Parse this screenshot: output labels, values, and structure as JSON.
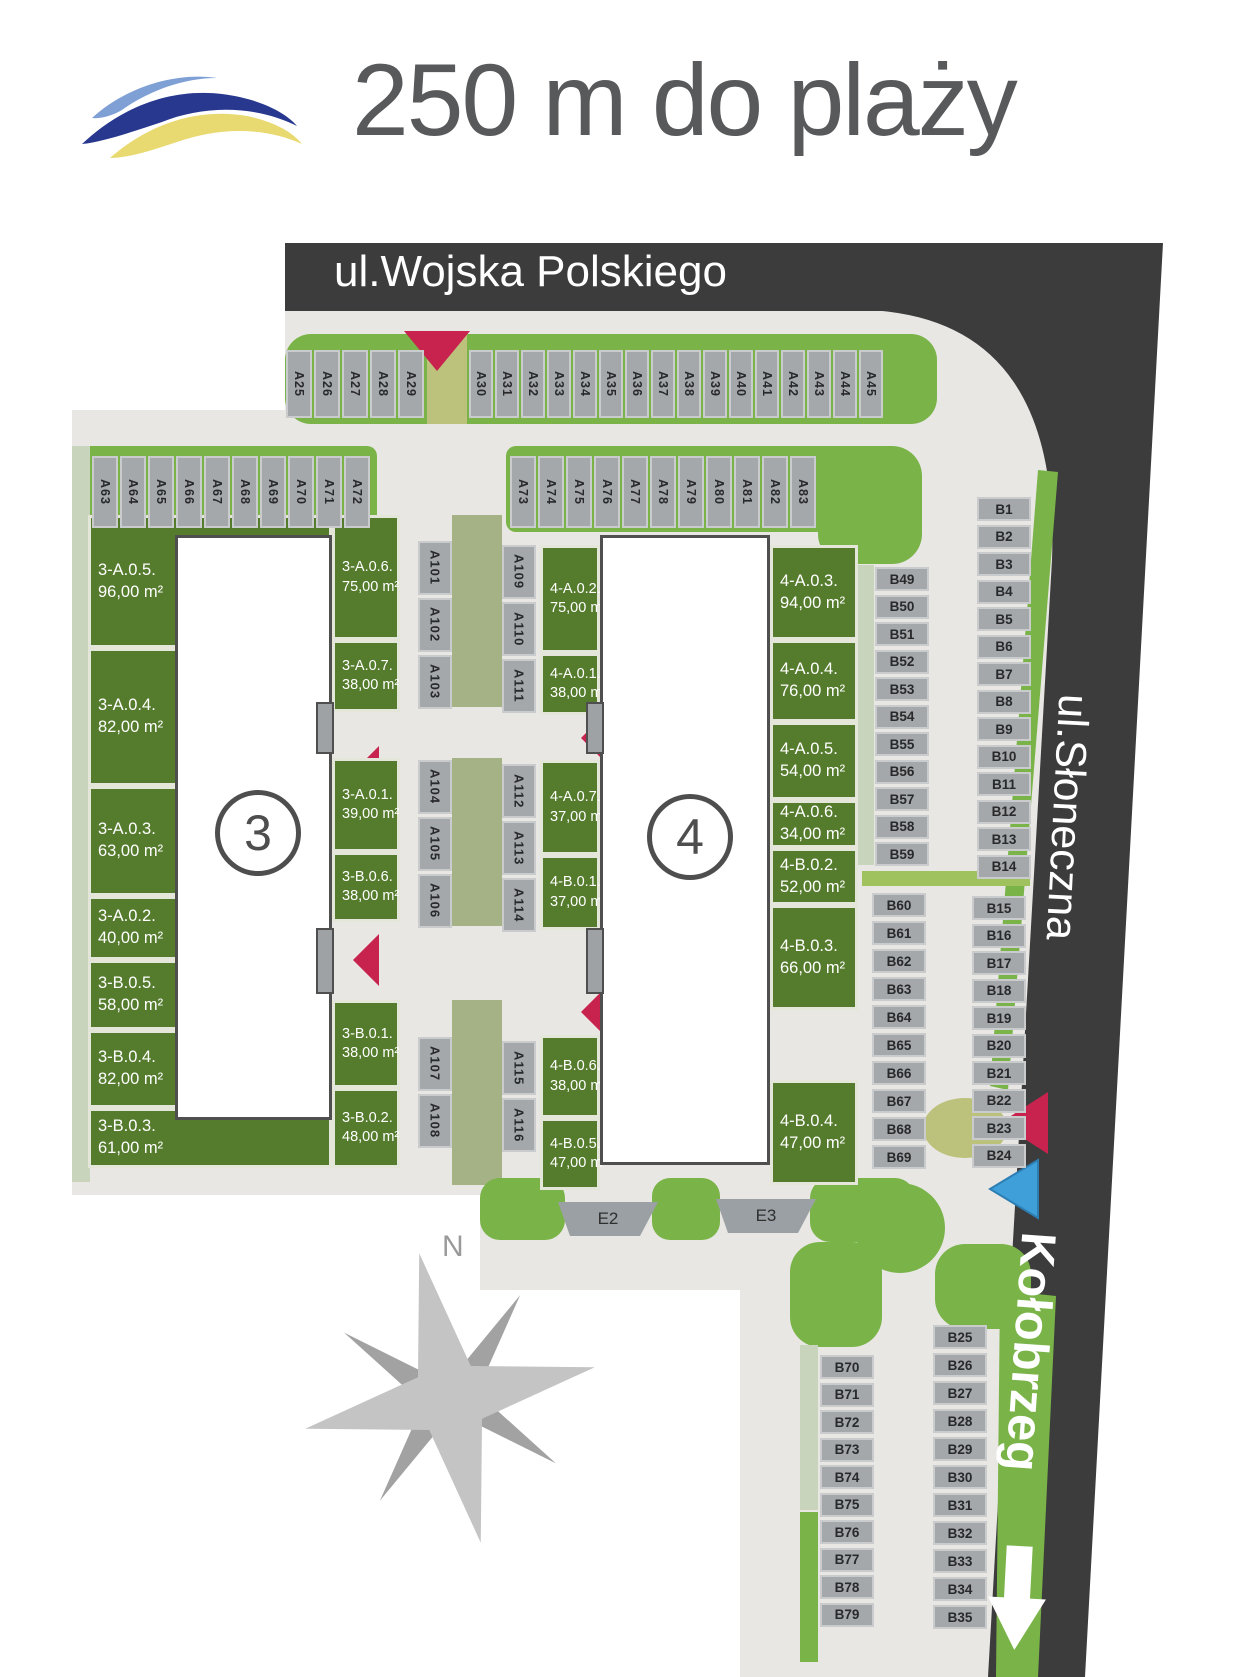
{
  "header": {
    "title": "250 m do plaży",
    "logo": "wave-logo"
  },
  "streets": {
    "top": "ul.Wojska Polskiego",
    "right": "ul.Słoneczna",
    "bottom_right": "Kołobrzeg"
  },
  "compass": {
    "label": "N"
  },
  "buildings": [
    {
      "number": "3"
    },
    {
      "number": "4"
    }
  ],
  "parking": {
    "row_top_left": [
      "A25",
      "A26",
      "A27",
      "A28",
      "A29"
    ],
    "row_top_right": [
      "A30",
      "A31",
      "A32",
      "A33",
      "A34",
      "A35",
      "A36",
      "A37",
      "A38",
      "A39",
      "A40",
      "A41",
      "A42",
      "A43",
      "A44",
      "A45"
    ],
    "row_mid_left": [
      "A63",
      "A64",
      "A65",
      "A66",
      "A67",
      "A68",
      "A69",
      "A70",
      "A71",
      "A72"
    ],
    "row_mid_right": [
      "A73",
      "A74",
      "A75",
      "A76",
      "A77",
      "A78",
      "A79",
      "A80",
      "A81",
      "A82",
      "A83"
    ],
    "col_center_left_1": [
      "A101",
      "A102",
      "A103"
    ],
    "col_center_left_2": [
      "A104",
      "A105",
      "A106"
    ],
    "col_center_left_3": [
      "A107",
      "A108"
    ],
    "col_center_right_1": [
      "A109",
      "A110",
      "A111"
    ],
    "col_center_right_2": [
      "A112",
      "A113",
      "A114"
    ],
    "col_center_right_3": [
      "A115",
      "A116"
    ],
    "col_b49": [
      "B49",
      "B50",
      "B51",
      "B52",
      "B53",
      "B54",
      "B55",
      "B56",
      "B57",
      "B58",
      "B59"
    ],
    "col_b60": [
      "B60",
      "B61",
      "B62",
      "B63",
      "B64",
      "B65",
      "B66",
      "B67",
      "B68",
      "B69"
    ],
    "col_b1": [
      "B1",
      "B2",
      "B3",
      "B4",
      "B5",
      "B6",
      "B7",
      "B8",
      "B9",
      "B10",
      "B11",
      "B12",
      "B13",
      "B14"
    ],
    "col_b15": [
      "B15",
      "B16",
      "B17",
      "B18",
      "B19",
      "B20",
      "B21",
      "B22",
      "B23",
      "B24"
    ],
    "col_b70": [
      "B70",
      "B71",
      "B72",
      "B73",
      "B74",
      "B75",
      "B76",
      "B77",
      "B78",
      "B79"
    ],
    "col_b25": [
      "B25",
      "B26",
      "B27",
      "B28",
      "B29",
      "B30",
      "B31",
      "B32",
      "B33",
      "B34",
      "B35"
    ],
    "pads": [
      "E2",
      "E3"
    ]
  },
  "apartments": {
    "b3_left": [
      {
        "id": "3-A.0.5.",
        "area": "96,00 m²"
      },
      {
        "id": "3-A.0.4.",
        "area": "82,00 m²"
      },
      {
        "id": "3-A.0.3.",
        "area": "63,00 m²"
      },
      {
        "id": "3-A.0.2.",
        "area": "40,00 m²"
      },
      {
        "id": "3-B.0.5.",
        "area": "58,00 m²"
      },
      {
        "id": "3-B.0.4.",
        "area": "82,00 m²"
      },
      {
        "id": "3-B.0.3.",
        "area": "61,00 m²"
      }
    ],
    "b3_right": [
      {
        "id": "3-A.0.6.",
        "area": "75,00 m²"
      },
      {
        "id": "3-A.0.7.",
        "area": "38,00 m²"
      },
      {
        "id": "3-A.0.1.",
        "area": "39,00 m²"
      },
      {
        "id": "3-B.0.6.",
        "area": "38,00 m²"
      },
      {
        "id": "3-B.0.1.",
        "area": "38,00 m²"
      },
      {
        "id": "3-B.0.2.",
        "area": "48,00 m²"
      }
    ],
    "b4_left": [
      {
        "id": "4-A.0.2.",
        "area": "75,00 m²"
      },
      {
        "id": "4-A.0.1.",
        "area": "38,00 m²"
      },
      {
        "id": "4-A.0.7.",
        "area": "37,00 m²"
      },
      {
        "id": "4-B.0.1.",
        "area": "37,00 m²"
      },
      {
        "id": "4-B.0.6.",
        "area": "38,00 m²"
      },
      {
        "id": "4-B.0.5.",
        "area": "47,00 m²"
      }
    ],
    "b4_right": [
      {
        "id": "4-A.0.3.",
        "area": "94,00 m²"
      },
      {
        "id": "4-A.0.4.",
        "area": "76,00 m²"
      },
      {
        "id": "4-A.0.5.",
        "area": "54,00 m²"
      },
      {
        "id": "4-A.0.6.",
        "area": "34,00 m²"
      },
      {
        "id": "4-B.0.2.",
        "area": "52,00 m²"
      },
      {
        "id": "4-B.0.3.",
        "area": "66,00 m²"
      },
      {
        "id": "4-B.0.4.",
        "area": "47,00 m²"
      }
    ]
  },
  "colors": {
    "asphalt": "#3d3c3c",
    "ground": "#e9e7e4",
    "grass_bright": "#7ab449",
    "garden_dark": "#557c2d",
    "sage_strip": "#a4b285",
    "olive_path": "#bcc27b",
    "stall_gray": "#a5a8ab",
    "arrow_red": "#c7234e",
    "arrow_blue": "#3f9fd8",
    "logo_light_blue": "#7fa0d4",
    "logo_dark_blue": "#28388f",
    "logo_yellow": "#e8da70",
    "title_gray": "#58595b"
  }
}
